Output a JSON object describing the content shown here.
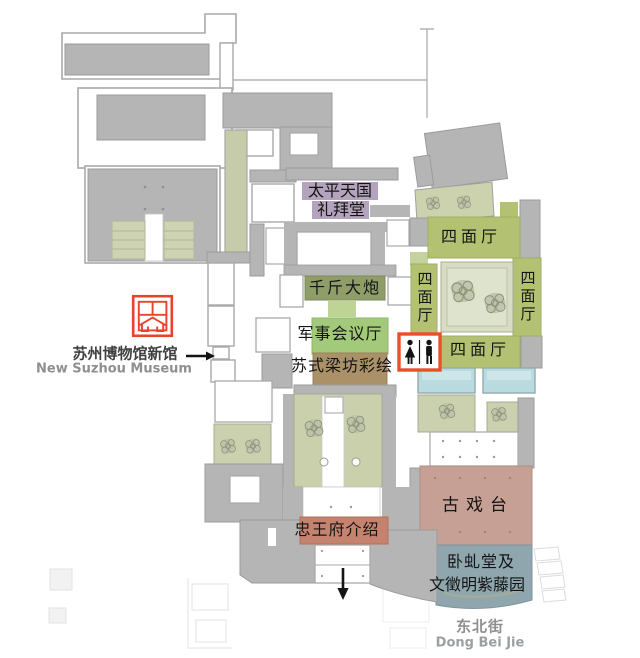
{
  "landmark": {
    "name_cn": "苏州博物馆新馆",
    "name_en": "New Suzhou Museum"
  },
  "street": {
    "name_cn": "东北街",
    "name_en": "Dong Bei Jie"
  },
  "halls": {
    "taiping_chapel": {
      "line1": "太平天国",
      "line2": "礼拜堂",
      "color": "#b4a3bc"
    },
    "cannon": {
      "label": "千斤大炮",
      "color": "#8f9d69"
    },
    "military_hall": {
      "label": "军事会议厅",
      "color": "#a3ca7b"
    },
    "beam_paintings": {
      "label": "苏式梁坊彩绘",
      "color": "#ab9168"
    },
    "four_sided_hall_top": {
      "label": "四面厅",
      "color": "#b3c173"
    },
    "four_sided_hall_left": {
      "label": "四面厅",
      "color": "#b3c173"
    },
    "four_sided_hall_right": {
      "label": "四面厅",
      "color": "#b3c173"
    },
    "four_sided_hall_bottom": {
      "label": "四面厅",
      "color": "#b3c173"
    },
    "ancient_stage": {
      "label": "古戏台",
      "color": "#c7a095"
    },
    "zhongwangfu_intro": {
      "label": "忠王府介绍",
      "color": "#c5836f"
    },
    "wisteria_garden": {
      "line1": "卧虬堂及",
      "line2": "文徵明紫藤园",
      "color": "#8fa6ae"
    }
  },
  "icons": {
    "restroom": "male-female-restroom",
    "museum_logo": "suzhou-museum-seal",
    "entrance_arrow": "arrow-right",
    "exit_arrow": "arrow-down"
  },
  "colors": {
    "building_gray": "#b5b5b5",
    "outline_gray": "#a9a9a9",
    "courtyard_green": "#cbd0ae",
    "pool_blue": "#b9dbe0",
    "accent_red": "#e8432b"
  }
}
